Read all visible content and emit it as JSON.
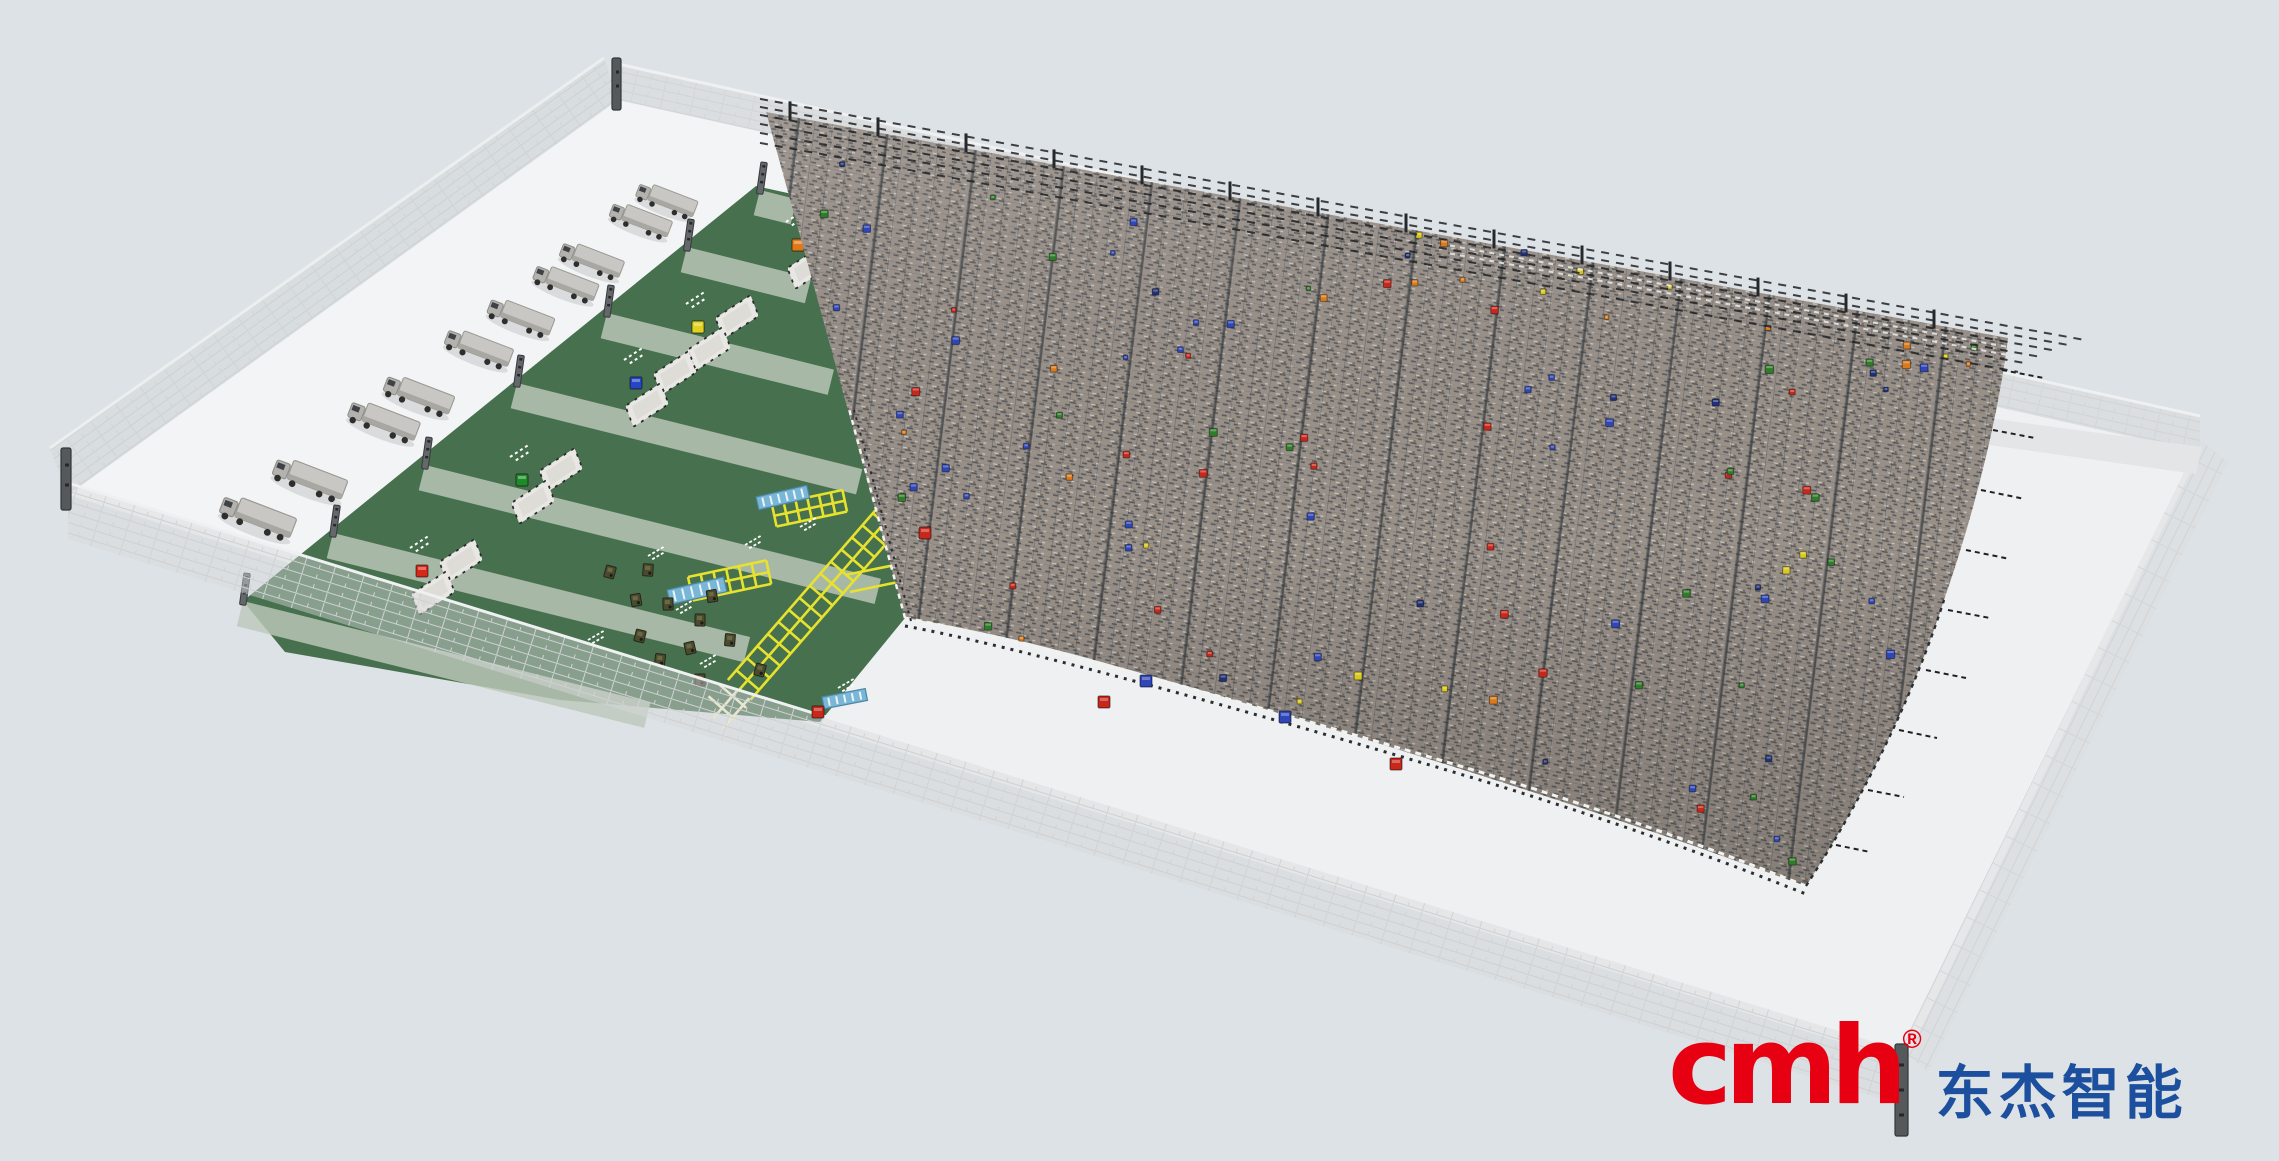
{
  "viewport": {
    "width": 2279,
    "height": 1161
  },
  "logo": {
    "brand": "cmh",
    "registered": "®",
    "name_cn": "东杰智能",
    "brand_color": "#e60012",
    "cn_color": "#1c4f9e"
  },
  "palette": {
    "background": "#dde2e6",
    "floor": "#eef0f1",
    "wall": "#d8dadb",
    "dock_area_green": "#47704e",
    "dock_strip": "#bdc8bb",
    "rack_steel": "#9a9189",
    "conveyor_rail_yellow": "#e6e22e",
    "conveyor_belt_blue": "#7ab6d6"
  },
  "scene": {
    "trucks": {
      "count": 10,
      "positions": [
        [
          666,
          201
        ],
        [
          640,
          221
        ],
        [
          591,
          261
        ],
        [
          565,
          284
        ],
        [
          520,
          318
        ],
        [
          478,
          349
        ],
        [
          418,
          396
        ],
        [
          383,
          422
        ],
        [
          309,
          480
        ],
        [
          257,
          518
        ]
      ]
    },
    "dock_stations": [
      {
        "id": "dock-1",
        "marker_color": "#e07818",
        "x": 822,
        "y": 252
      },
      {
        "id": "dock-2",
        "marker_color": "#e0d020",
        "x": 722,
        "y": 334
      },
      {
        "id": "dock-3",
        "marker_color": "#2644c4",
        "x": 660,
        "y": 390
      },
      {
        "id": "dock-4",
        "marker_color": "#1e8a28",
        "x": 546,
        "y": 487
      },
      {
        "id": "dock-5",
        "marker_color": "#d42818",
        "x": 446,
        "y": 578
      }
    ],
    "storage_rack": {
      "box_count": 95,
      "box_colors": [
        "#2e46b8",
        "#c8281c",
        "#2f7d2a",
        "#20307a",
        "#d97a1e",
        "#d8c820"
      ]
    },
    "floor_boxes": [
      {
        "x": 1104,
        "y": 702,
        "color": "#c8281c"
      },
      {
        "x": 1146,
        "y": 681,
        "color": "#2e46b8"
      },
      {
        "x": 1285,
        "y": 717,
        "color": "#2e46b8"
      },
      {
        "x": 1396,
        "y": 764,
        "color": "#c8281c"
      },
      {
        "x": 925,
        "y": 533,
        "color": "#c8281c"
      },
      {
        "x": 818,
        "y": 712,
        "color": "#c8281c"
      }
    ]
  }
}
